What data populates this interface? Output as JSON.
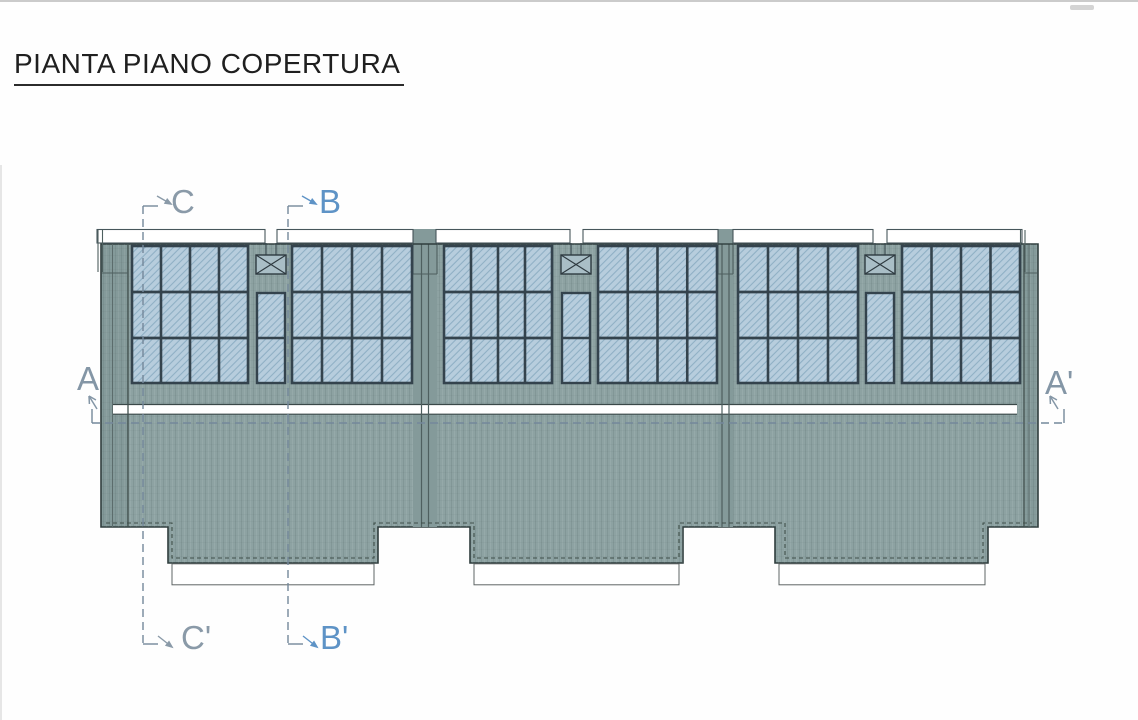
{
  "title": "PIANTA PIANO COPERTURA",
  "drawing": {
    "type": "architectural roof plan",
    "modules": 3,
    "solar_panel_arrays_per_module": 2,
    "panel_array_grid": {
      "columns": 4,
      "rows": 3
    },
    "center_panel_strip": {
      "columns": 1,
      "rows": 2
    },
    "roof_vent_boxes": 3,
    "sections": [
      {
        "label_start": "A",
        "label_end": "A'",
        "orientation": "horizontal",
        "color": "#8496a6"
      },
      {
        "label_start": "B",
        "label_end": "B'",
        "orientation": "vertical",
        "color": "#5e93c6"
      },
      {
        "label_start": "C",
        "label_end": "C'",
        "orientation": "vertical",
        "color": "#8a9aa8"
      }
    ],
    "colors": {
      "roof_fill": "#8da2a2",
      "band_overlay": "rgba(40,60,60,0.08)",
      "outline": "#2f3d3d",
      "panel_fill": "#b7cddd",
      "panel_hatch": "#8fafc4",
      "panel_grid": "#34434d",
      "strip_fill": "#ffffff",
      "strip_stroke": "#47565b",
      "ridge_gap_fill": "#ffffff",
      "canopy_stroke": "#5f6565",
      "dashed_inset": "#3f4f49",
      "section_dash": "#74889b",
      "vent_box_fill": "#a9bec6",
      "title_color": "#1f1f1f"
    }
  }
}
